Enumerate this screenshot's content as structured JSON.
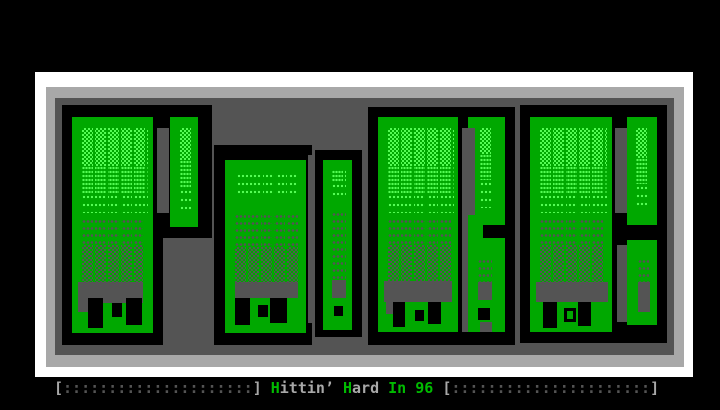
{
  "window": {
    "width": 720,
    "height": 410,
    "background": "#000000"
  },
  "palette": {
    "background": "#000000",
    "frame_outer_white": "#ffffff",
    "frame_inner_gray": "#a8a8a8",
    "panel_dark_gray": "#545454",
    "letter_fill_green": "#00a800",
    "letter_highlight_green": "#54fc54",
    "letter_outline": "#000000",
    "caption_green": "#00bb00",
    "caption_gray": "#a8a8a8",
    "caption_dim_gray": "#545454"
  },
  "artwork": {
    "style": "ANSI block letters with dither shading and drip shapes",
    "letters": [
      "P",
      "O",
      "R",
      "K"
    ]
  },
  "caption": {
    "full_text": "[:::::::::::::::::::::] Hittin’ Hard In 96 [::::::::::::::::::::::]",
    "parts": [
      {
        "text": "[",
        "role": "bracket"
      },
      {
        "text": ":::::::::::::::::::::",
        "role": "dots"
      },
      {
        "text": "]",
        "role": "bracket"
      },
      {
        "text": " ",
        "role": "space"
      },
      {
        "text": "H",
        "role": "accent"
      },
      {
        "text": "ittin’",
        "role": "plain"
      },
      {
        "text": " ",
        "role": "space"
      },
      {
        "text": "H",
        "role": "accent"
      },
      {
        "text": "ard",
        "role": "plain"
      },
      {
        "text": " ",
        "role": "space"
      },
      {
        "text": "In",
        "role": "accent"
      },
      {
        "text": " ",
        "role": "space"
      },
      {
        "text": "96",
        "role": "accent"
      },
      {
        "text": " ",
        "role": "space"
      },
      {
        "text": "[",
        "role": "bracket"
      },
      {
        "text": "::::::::::::::::::::::",
        "role": "dots"
      },
      {
        "text": "]",
        "role": "bracket"
      }
    ]
  }
}
